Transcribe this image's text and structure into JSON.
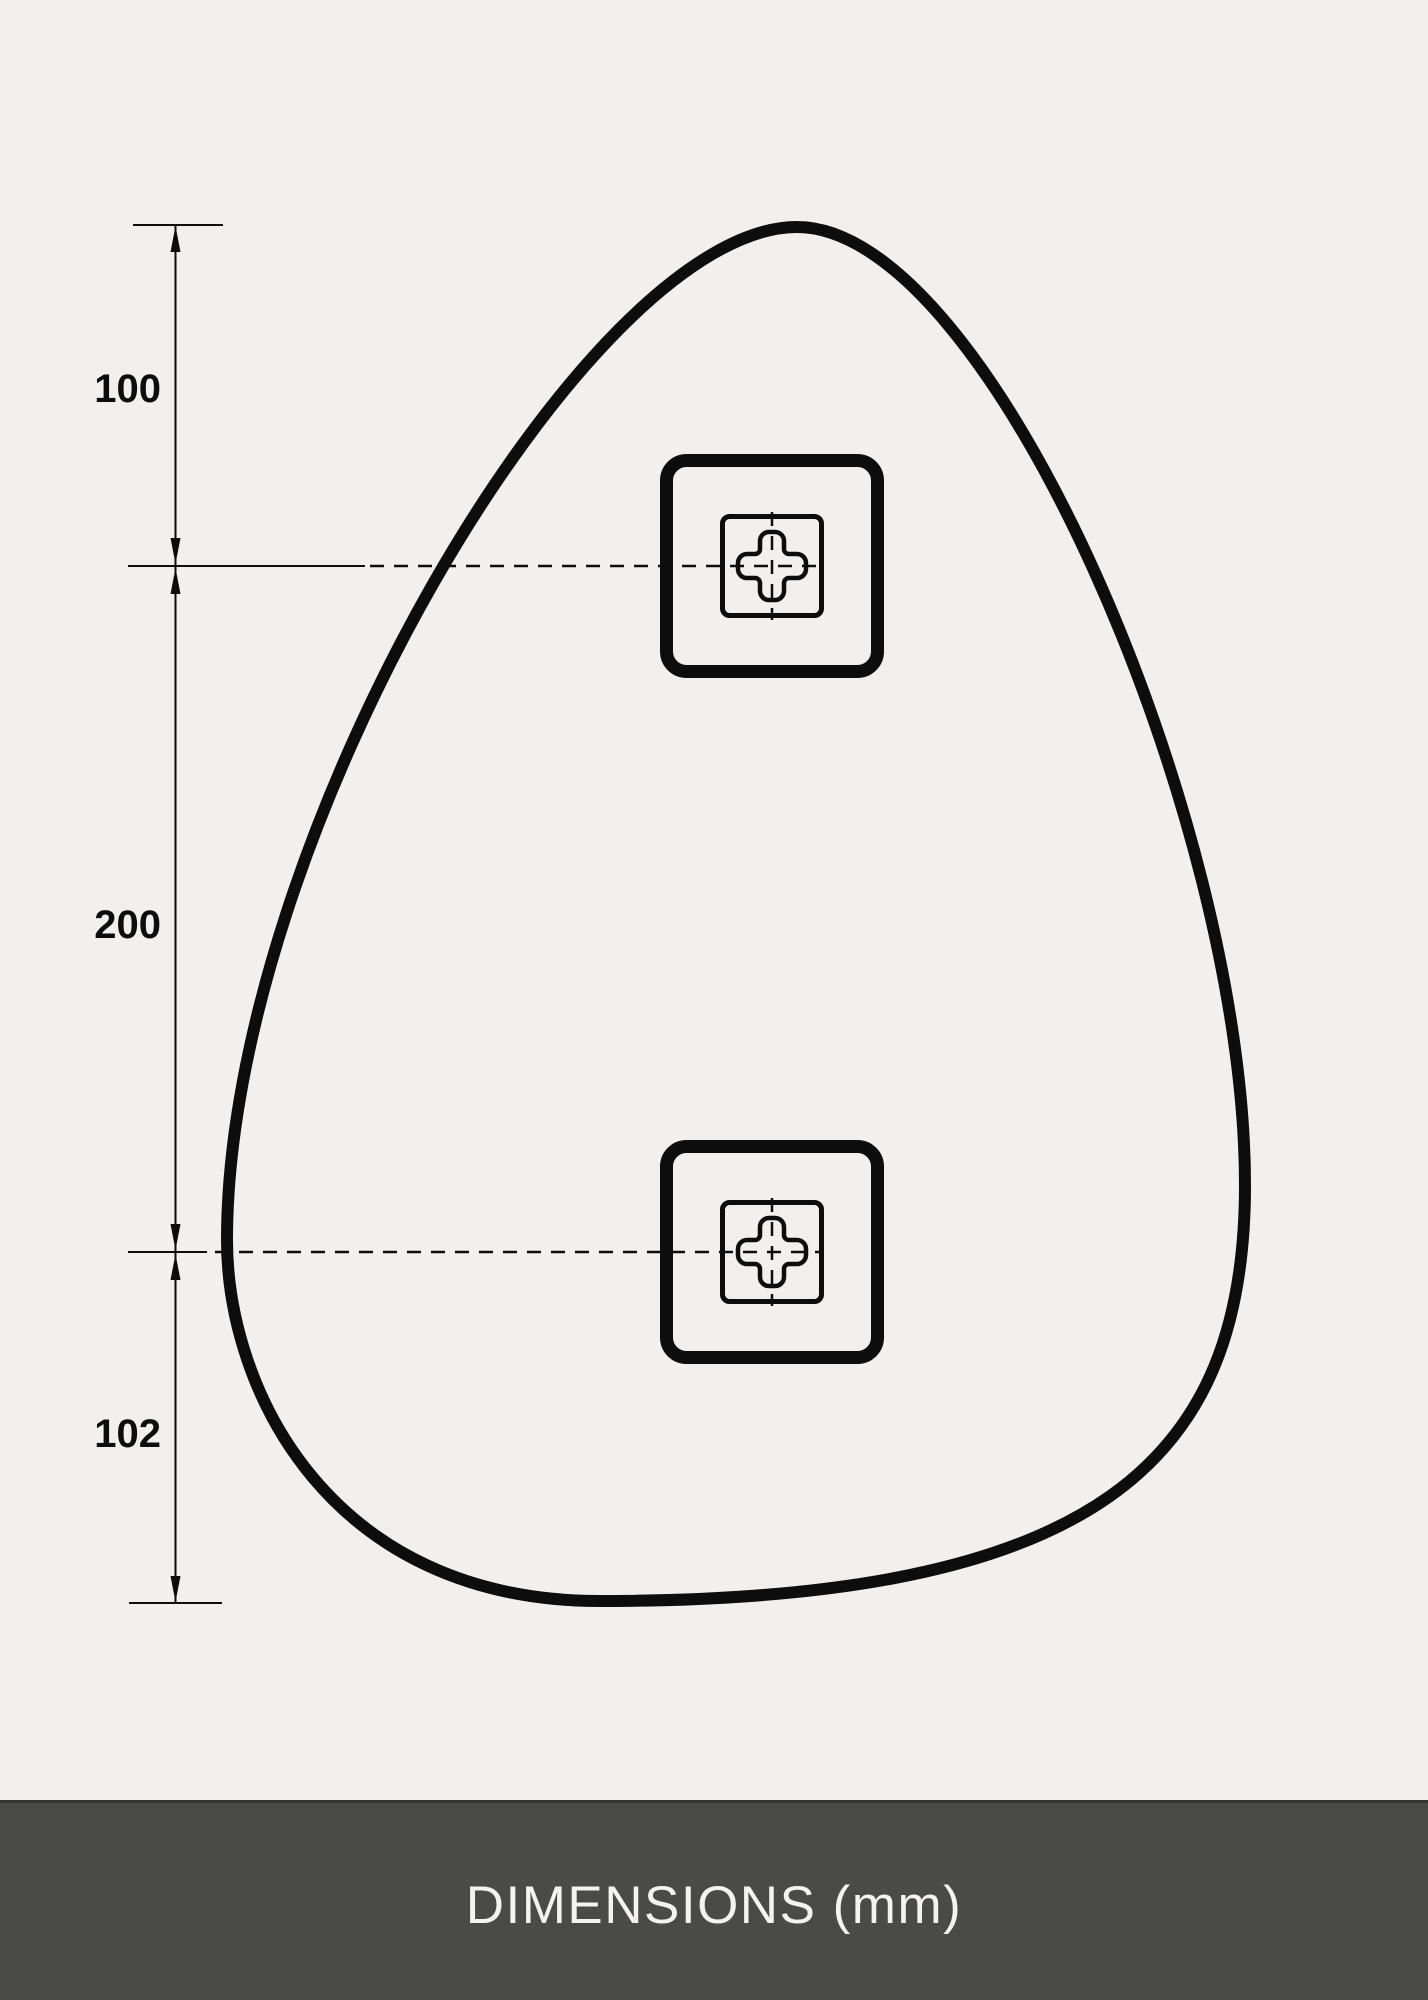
{
  "drawing": {
    "dimension_labels": [
      {
        "id": "top-edge-to-upper-bracket",
        "value": "100"
      },
      {
        "id": "upper-bracket-to-lower-bracket",
        "value": "200"
      },
      {
        "id": "lower-bracket-to-bottom-edge",
        "value": "102"
      }
    ],
    "icons": [
      {
        "name": "cross-slot-icon",
        "meaning": "keyhole mounting bracket cross slot"
      }
    ]
  },
  "footer": {
    "caption": "DIMENSIONS (mm)"
  },
  "colors": {
    "background": "#f1f0ee",
    "line": "#0d0d0d",
    "footer_background": "#4a4a48",
    "footer_text": "#f4f3f1"
  }
}
